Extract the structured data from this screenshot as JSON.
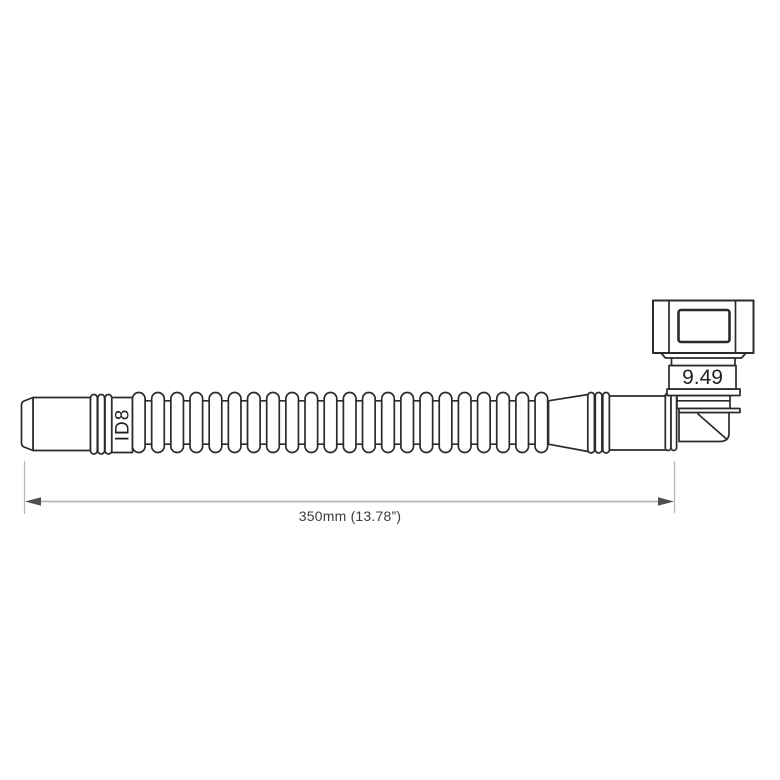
{
  "drawing": {
    "type": "technical-line-drawing",
    "subject": "corrugated hose assembly with 90-degree quick connector"
  },
  "hose": {
    "id_label": "ID8",
    "corrugation_rib_count": 22
  },
  "connector": {
    "size_label": "9.49"
  },
  "dimension": {
    "length_label": "350mm (13.78”)",
    "value_mm": 350,
    "value_in": 13.78
  },
  "colors": {
    "outline": "#2b2b2b",
    "dimension_line": "#b5b5b5",
    "dimension_arrow": "#4e4e4e",
    "label_text": "#3c3c3c",
    "background": "#ffffff"
  }
}
